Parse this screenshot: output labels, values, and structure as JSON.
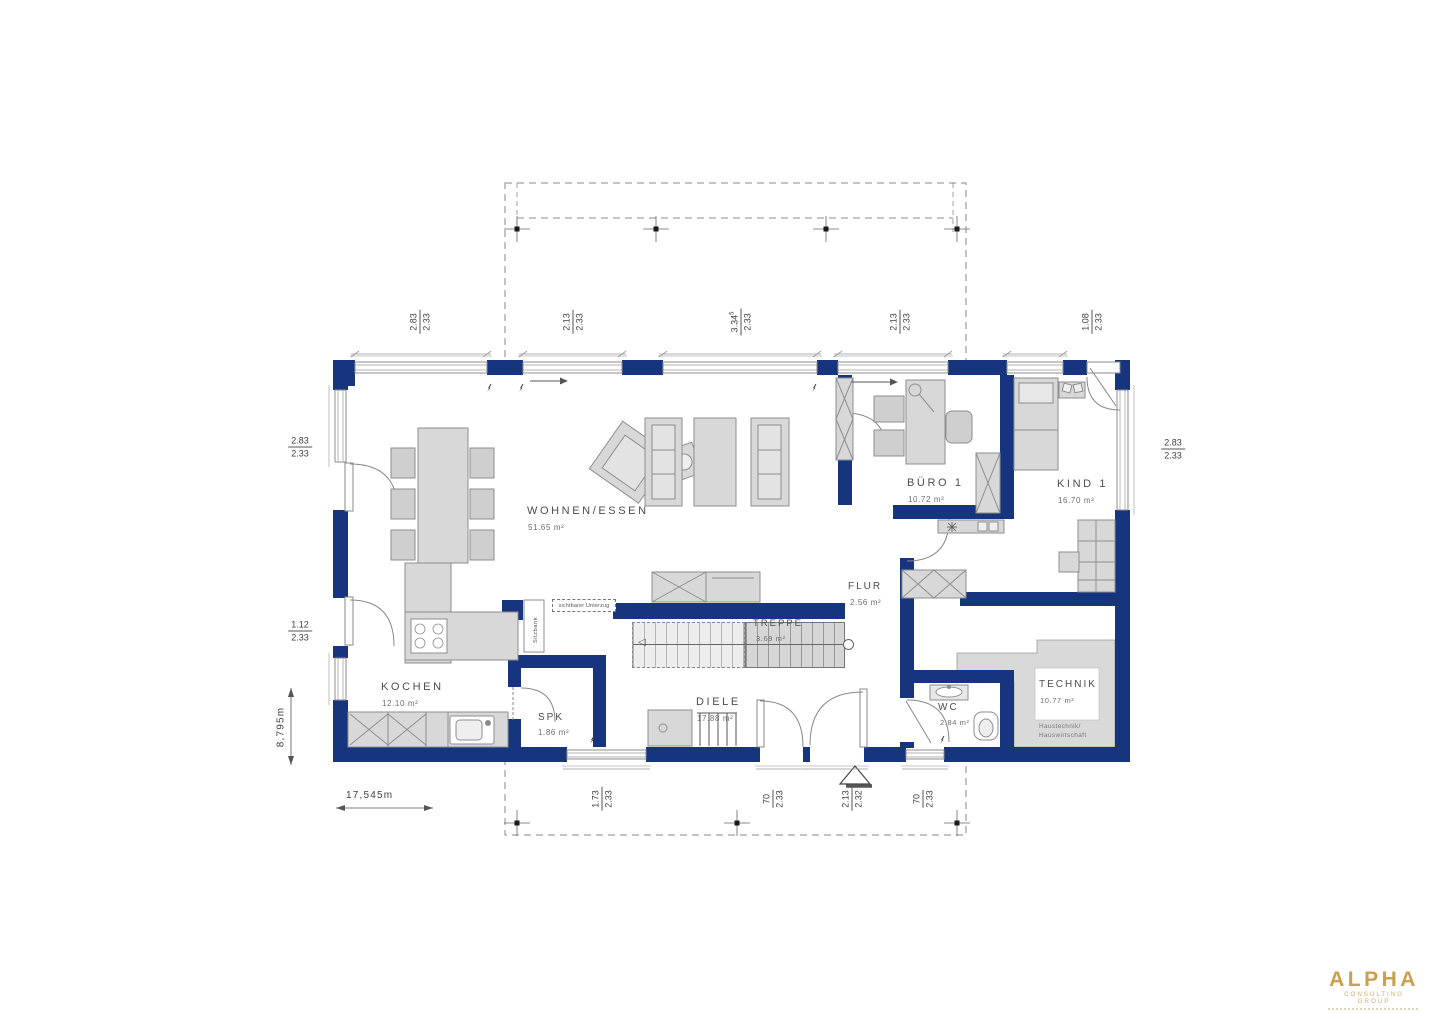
{
  "rooms": {
    "wohnen": {
      "name": "WOHNEN/ESSEN",
      "area": "51.65 m²"
    },
    "kochen": {
      "name": "KOCHEN",
      "area": "12.10 m²"
    },
    "spk": {
      "name": "SPK",
      "area": "1.86 m²"
    },
    "diele": {
      "name": "DIELE",
      "area": "17.88 m²"
    },
    "treppe": {
      "name": "TREPPE",
      "area": "3.69 m²"
    },
    "flur": {
      "name": "FLUR",
      "area": "2.56 m²"
    },
    "buero": {
      "name": "BÜRO 1",
      "area": "10.72 m²"
    },
    "kind": {
      "name": "KIND 1",
      "area": "16.70 m²"
    },
    "wc": {
      "name": "WC",
      "area": "2.84 m²"
    },
    "technik": {
      "name": "TECHNIK",
      "area": "10.77 m²",
      "note1": "Haustechnik/",
      "note2": "Hauswirtschaft"
    }
  },
  "annotations": {
    "beam": "sichtbarer Unterzug",
    "bench": "Sitzbank"
  },
  "dimensions": {
    "top": [
      {
        "num": "2.83",
        "den": "2.33"
      },
      {
        "num": "2.13",
        "den": "2.33"
      },
      {
        "num": "3.34",
        "sup": "5",
        "den": "2.33"
      },
      {
        "num": "2.13",
        "den": "2.33"
      },
      {
        "num": "1.08",
        "den": "2.33"
      }
    ],
    "left": [
      {
        "num": "2.83",
        "den": "2.33"
      },
      {
        "num": "1.12",
        "den": "2.33"
      }
    ],
    "right": [
      {
        "num": "2.83",
        "den": "2.33"
      }
    ],
    "bottom": [
      {
        "num": "1.73",
        "den": "2.33"
      },
      {
        "num": "70",
        "den": "2.33"
      },
      {
        "num": "2.13",
        "den": "2.32"
      },
      {
        "num": "70",
        "den": "2.33"
      }
    ],
    "total_width": "17,545m",
    "total_height": "8,795m"
  },
  "colors": {
    "wall": "#17357E",
    "furniture_fill": "#d8d8d8",
    "furniture_stroke": "#8e8e8e",
    "logo_gold": "#C9A14E"
  },
  "logo": {
    "title": "ALPHA",
    "subtitle": "CONSULTING GROUP"
  }
}
